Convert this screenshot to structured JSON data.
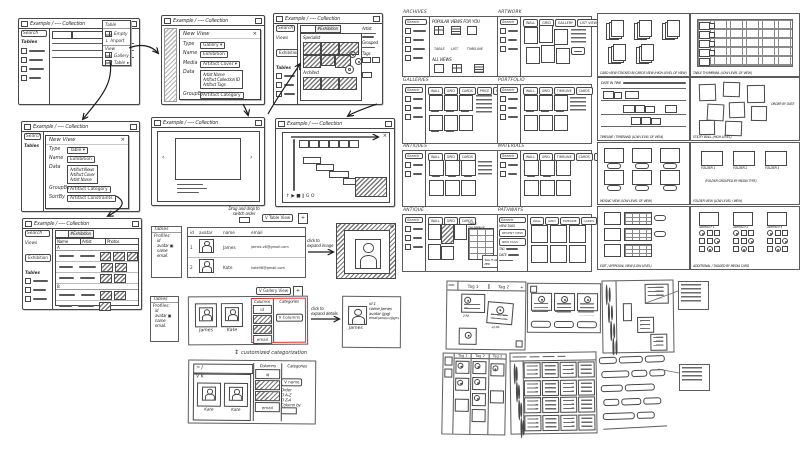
{
  "window_title": "Example / ---- Collection",
  "menu": {
    "header": "Table",
    "items": [
      "Empty",
      "Import",
      "View",
      "Gallery",
      "Table"
    ]
  },
  "sidebar": {
    "search": "Search",
    "tables": "Tables",
    "views": "Views",
    "exhibition": "Exhibition"
  },
  "dialog_gallery": {
    "title": "New View",
    "close": "×",
    "type_label": "Type",
    "type_value": "Gallery ▾",
    "name_label": "Name",
    "name_value": "Exhibition",
    "media_label": "Media",
    "media_value": "Artifact Cover ▾",
    "data_label": "Data",
    "data_items": [
      "Artist Name",
      "Artifact Collection ID",
      "Artifact Tags"
    ],
    "groupby_label": "GroupBy",
    "groupby_value": "Artifact Category"
  },
  "dialog_table": {
    "title": "New View",
    "close": "×",
    "type_label": "Type",
    "type_value": "Table ▾",
    "name_label": "Name",
    "name_value": "Exhibition",
    "data_label": "Data",
    "data_items": [
      "Artifact News",
      "Artifact Cover",
      "Artist Name"
    ],
    "groupby_label": "GroupBy",
    "groupby_value": "Artifact Category",
    "sortby_label": "SortBy",
    "sortby_value": "Artifact Constraints"
  },
  "gallery_window": {
    "tab": "#Exhibition",
    "group1": "Specialist",
    "group2": "Architect",
    "artist": "Artist",
    "grouped": "Grouped",
    "tags": "Tags"
  },
  "carousel_window": {
    "prev": "‹",
    "next": "›"
  },
  "player_window": {
    "controls": "↑  ▶ ■ ‖ G O",
    "close": "×"
  },
  "table_window": {
    "tab": "#Exhibition",
    "columns": [
      "Name",
      "Artist",
      "Photos"
    ],
    "groups": [
      "A",
      "B"
    ]
  },
  "profiles_box": {
    "title": "Tables",
    "heading": "Profiles:",
    "fields": [
      "id",
      "avatar ▣",
      "name",
      "email."
    ]
  },
  "table_view": {
    "note1": "Drag and drop to",
    "note2": "switch order",
    "switcher": "V Table View",
    "add": "+",
    "columns": [
      "id",
      "avatar",
      "name",
      "email"
    ],
    "rows": [
      {
        "id": "1",
        "name": "James",
        "email": "james.v8@gmail.com"
      },
      {
        "id": "2",
        "name": "Kate",
        "email": "kate98@gmail.com"
      }
    ]
  },
  "expand_image": {
    "note1": "click to",
    "note2": "expand image",
    "close": "⊗"
  },
  "gallery_view": {
    "switcher": "V Gallery View",
    "add": "+",
    "cards": [
      "James",
      "Kate"
    ],
    "columns_label": "Columns",
    "col_id": "id",
    "col_email": "email",
    "categories_label": "Categories",
    "categories_chip": "V Columns"
  },
  "expand_details": {
    "note1": "click to",
    "note2": "expand details",
    "name": "James",
    "lines": [
      "id 1",
      "name James",
      "avatar (jpg)",
      "email james.v@gmail.com"
    ]
  },
  "customize": {
    "arrow": "↕",
    "label": "customized categorization"
  },
  "custom_panel": {
    "row_j": "> J",
    "group_k": "V K",
    "cards": [
      "Kate",
      "Kate"
    ],
    "columns_label": "Columns",
    "col_id": "id",
    "col_email": "email",
    "categories_label": "Categories",
    "name_chip": "V name",
    "order_label": "Order",
    "order_az": "O A-Z",
    "order_za": "O Z-A",
    "columnby": "Column by"
  },
  "browse": [
    {
      "title": "ARCHIVES",
      "heading1": "POPULAR VIEWS FOR YOU",
      "icons1": [
        "TABLE",
        "LIST",
        "TIMELINE"
      ],
      "heading2": "ALL VIEWS",
      "icons2": [
        "CARDS",
        "GALLERY",
        "WALL"
      ]
    },
    {
      "title": "ARTWORK",
      "chips": [
        "WALL",
        "GRID",
        "GALLERY",
        "LIST VIEW"
      ]
    },
    {
      "title": "GALLERIES",
      "chips": [
        "WALL",
        "GRID",
        "CARDS",
        "PRICE",
        "FILTER"
      ]
    },
    {
      "title": "PORTFOLIO",
      "chips": [
        "WALL",
        "GRID",
        "TIMELINE",
        "CARDS"
      ]
    },
    {
      "title": "ANTIQUES",
      "chips": [
        "WALL",
        "GRID",
        "CARDS"
      ]
    },
    {
      "title": "MATERIALS",
      "chips": [
        "WALL",
        "GRID",
        "TIMELINE",
        "CARDS",
        "FOLDER"
      ]
    },
    {
      "title": "ANTIQUE",
      "chips": [
        "WALL",
        "GRID",
        "CARDS"
      ],
      "subpanel": "TABLE THUMBNAIL",
      "subnote": "TAG IT AS PER"
    },
    {
      "title": "PATHWAYS",
      "side_label": "VIEW TAGS",
      "buttons": [
        "RECENT VIEW",
        "NEW TAGS"
      ],
      "fields": [
        "TAG",
        "DATE"
      ],
      "chips": [
        "WALL",
        "GRID",
        "TIMELINE",
        "CARDS",
        "FOLDER"
      ]
    }
  ],
  "levels": [
    {
      "caption": "CARD VIEW STACKED IN CARDS VIEW (HIGH LEVEL OF VIEW)"
    },
    {
      "caption": "TABLE THUMBNAIL (LOW LEVEL OF VIEW)"
    },
    {
      "label": "DATE IN TIME",
      "caption": "TIMELINE / TIMEBAND (LOW LEVEL OF VIEW)"
    },
    {
      "caption": "STICKY WALL (HIGH LEVEL)",
      "note": "ORDER BY DATE"
    },
    {
      "caption": "MOSAIC VIEW (LOW LEVEL OF VIEW)"
    },
    {
      "folders": [
        "FOLDER 1",
        "FOLDER 2",
        "FOLDER 3"
      ],
      "note": "(FOLDER GROUPED BY MEDIA TYPE)",
      "caption": "FOLDER VIEW (LOW LEVEL / VIEW)"
    },
    {
      "caption": "EDIT / APPROVAL VIEW (LOW LEVEL)"
    },
    {
      "labels": [
        "ARTIFACT 1",
        "ARTIFACT 2",
        "ARTIFACT 3"
      ],
      "caption": "ADDITIONAL / TAGGED BY MEDIA CARD"
    }
  ],
  "boards": {
    "tabs": [
      "Tag 1",
      "Tag 2"
    ],
    "add": "+",
    "kanban": [
      "Tag 1",
      "Tag 2",
      "Tag 3"
    ]
  }
}
